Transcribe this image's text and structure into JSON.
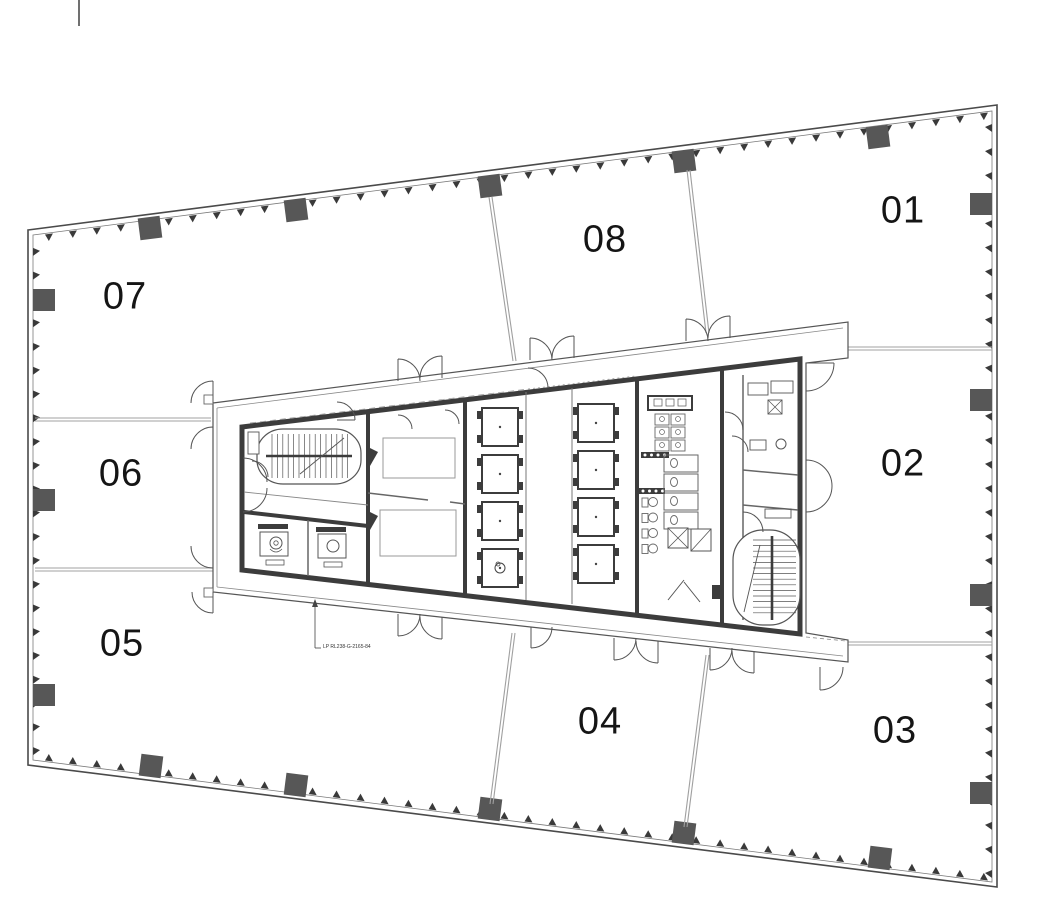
{
  "zones": {
    "z01": "01",
    "z02": "02",
    "z03": "03",
    "z04": "04",
    "z05": "05",
    "z06": "06",
    "z07": "07",
    "z08": "08"
  },
  "annotation": {
    "text": "LP RL238-G-2165-84"
  },
  "colors": {
    "background": "#ffffff",
    "wall": "#4a4a4a",
    "wall_inner": "#7a7a7a",
    "core_wall": "#3c3c3c",
    "column": "#575757",
    "thin_wall": "#666666",
    "light_line": "#999999",
    "demising_line": "#a0a0a0",
    "label_text": "#151515"
  }
}
